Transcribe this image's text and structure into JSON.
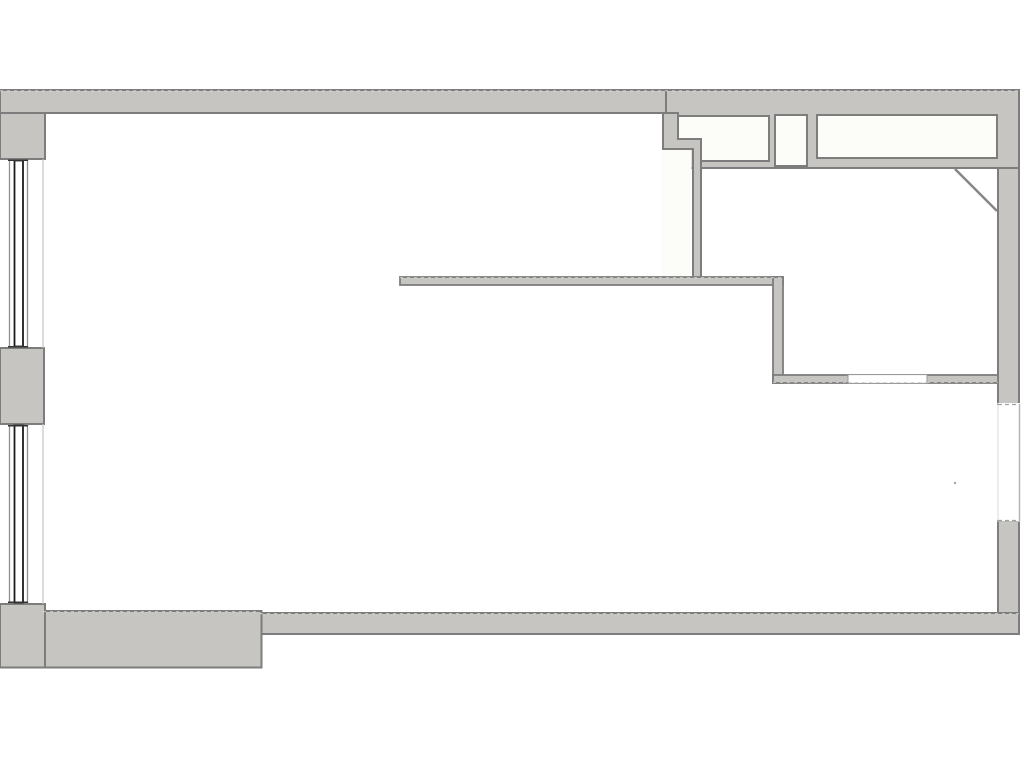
{
  "meta": {
    "title": "Floor plan drawing",
    "canvas_width": 1024,
    "canvas_height": 768
  },
  "colors": {
    "background": "#ffffff",
    "paper": "#fcfcf8",
    "wall_fill": "#c6c5c2",
    "wall_line": "#7d7d7d",
    "diag_line": "#868686",
    "window_dark": "#1c1c1c",
    "window_cap": "#333333",
    "window_mid": "#8f8f8f",
    "window_light": "#c6c6c6",
    "thin_line": "#9a9a9a",
    "dash_line": "#a0a0a0",
    "gap_outer": "#b5b5b5",
    "gap_inner": "#d9d9d9",
    "white": "#ffffff",
    "speck": "#a5a5a5",
    "dash_overlay": "#ffffff"
  },
  "shapes": [
    {
      "name": "left-wall-upper-block",
      "type": "rect",
      "x": 0,
      "y": 90,
      "w": 45,
      "h": 69,
      "fill": "wall_fill",
      "stroke": "wall_line",
      "sw": 2
    },
    {
      "name": "left-wall-pier",
      "type": "rect",
      "x": 0,
      "y": 348,
      "w": 44,
      "h": 76,
      "fill": "wall_fill",
      "stroke": "wall_line",
      "sw": 2
    },
    {
      "name": "right-wall-upper",
      "type": "rect",
      "x": 998,
      "y": 90,
      "w": 21,
      "h": 314,
      "fill": "wall_fill",
      "stroke": "wall_line",
      "sw": 2
    },
    {
      "name": "right-wall-lower",
      "type": "rect",
      "x": 998,
      "y": 521,
      "w": 21,
      "h": 113,
      "fill": "wall_fill",
      "stroke": "wall_line",
      "sw": 2
    },
    {
      "name": "top-right-wall-block",
      "type": "rect",
      "x": 663,
      "y": 90,
      "w": 356,
      "h": 78,
      "fill": "wall_fill",
      "stroke": "wall_line",
      "sw": 2
    },
    {
      "name": "top-wall",
      "type": "rect",
      "x": 0,
      "y": 90,
      "w": 666,
      "h": 23,
      "fill": "wall_fill",
      "stroke": "wall_line",
      "sw": 2
    },
    {
      "name": "open-area-notch",
      "type": "rect",
      "x": 661.5,
      "y": 150,
      "w": 30,
      "h": 128,
      "fill": "paper"
    },
    {
      "name": "interior-wall-step",
      "type": "path",
      "d": "M663,113 L678,113 L678,139 L701,139 L701,278 L693,278 L693,149 L663,149 Z",
      "fill": "wall_fill",
      "stroke": "wall_line",
      "sw": 2
    },
    {
      "name": "room-closet",
      "type": "path",
      "d": "M678,116 L769,116 L769,161 L701,161 L701,139 L678,139 Z",
      "fill": "paper",
      "stroke": "wall_line",
      "sw": 2
    },
    {
      "name": "room-shaft",
      "type": "rect",
      "x": 775,
      "y": 115,
      "w": 32,
      "h": 51,
      "fill": "paper",
      "stroke": "wall_line",
      "sw": 2
    },
    {
      "name": "room-top-right",
      "type": "rect",
      "x": 817,
      "y": 115,
      "w": 180,
      "h": 43,
      "fill": "paper",
      "stroke": "wall_line",
      "sw": 2
    },
    {
      "name": "door-diagonal-line",
      "type": "line",
      "x1": 955,
      "y1": 169,
      "x2": 997,
      "y2": 211,
      "stroke": "diag_line",
      "sw": 2.5
    },
    {
      "name": "interior-wall-long",
      "type": "rect",
      "x": 400,
      "y": 277,
      "w": 383,
      "h": 8,
      "fill": "wall_fill",
      "stroke": "wall_line",
      "sw": 1.8
    },
    {
      "name": "interior-wall-vertical",
      "type": "rect",
      "x": 773,
      "y": 277,
      "w": 10,
      "h": 106,
      "fill": "wall_fill",
      "stroke": "wall_line",
      "sw": 1.8
    },
    {
      "name": "interior-wall-lower",
      "type": "rect",
      "x": 773,
      "y": 375,
      "w": 225,
      "h": 8,
      "fill": "wall_fill",
      "stroke": "wall_line",
      "sw": 1.8
    },
    {
      "name": "interior-wall-opening",
      "type": "rect",
      "x": 848,
      "y": 374.6,
      "w": 79,
      "h": 8.8,
      "fill": "white",
      "stroke": "thin_line",
      "sw": 1
    },
    {
      "name": "opening-dash-edge",
      "type": "line",
      "x1": 848,
      "y1": 383,
      "x2": 927,
      "y2": 383,
      "stroke": "dash_line",
      "sw": 1,
      "dash": "4,3"
    },
    {
      "name": "bottom-wall-main",
      "type": "rect",
      "x": 260,
      "y": 613,
      "w": 759,
      "h": 21,
      "fill": "wall_fill",
      "stroke": "wall_line",
      "sw": 2
    },
    {
      "name": "bottom-wall-left",
      "type": "rect",
      "x": 43,
      "y": 611,
      "w": 218.5,
      "h": 56.5,
      "fill": "wall_fill",
      "stroke": "wall_line",
      "sw": 2
    },
    {
      "name": "bottom-wall-left-corner",
      "type": "rect",
      "x": 0,
      "y": 604,
      "w": 45,
      "h": 63.5,
      "fill": "wall_fill",
      "stroke": "wall_line",
      "sw": 2
    },
    {
      "name": "right-window-gap",
      "type": "rect",
      "x": 997.5,
      "y": 403,
      "w": 23.5,
      "h": 118.5,
      "fill": "white"
    },
    {
      "name": "right-window-outer-line",
      "type": "line",
      "x1": 1019.5,
      "y1": 404,
      "x2": 1019.5,
      "y2": 521,
      "stroke": "gap_outer",
      "sw": 1.5
    },
    {
      "name": "right-window-inner-line",
      "type": "line",
      "x1": 998,
      "y1": 404,
      "x2": 998,
      "y2": 521,
      "stroke": "gap_inner",
      "sw": 1
    },
    {
      "name": "right-window-dash-top",
      "type": "line",
      "x1": 998,
      "y1": 404.5,
      "x2": 1019,
      "y2": 404.5,
      "stroke": "dash_line",
      "sw": 1.3,
      "dash": "4,3"
    },
    {
      "name": "right-window-dash-bottom",
      "type": "line",
      "x1": 998,
      "y1": 520.5,
      "x2": 1019,
      "y2": 520.5,
      "stroke": "dash_line",
      "sw": 1.3,
      "dash": "4,3"
    },
    {
      "name": "window1-side-line-left",
      "type": "line",
      "x1": 9.5,
      "y1": 159.5,
      "x2": 9.5,
      "y2": 347,
      "stroke": "window_mid",
      "sw": 1.3
    },
    {
      "name": "window1-frame",
      "type": "rect",
      "x": 14.5,
      "y": 160.5,
      "w": 8.5,
      "h": 186,
      "fill": "none",
      "stroke": "window_dark",
      "sw": 1.8
    },
    {
      "name": "window1-side-line-right",
      "type": "line",
      "x1": 27.5,
      "y1": 159.5,
      "x2": 27.5,
      "y2": 347,
      "stroke": "window_mid",
      "sw": 1.3
    },
    {
      "name": "window1-face-line",
      "type": "line",
      "x1": 43,
      "y1": 159,
      "x2": 43,
      "y2": 348,
      "stroke": "window_light",
      "sw": 1.2
    },
    {
      "name": "window1-cap-top",
      "type": "line",
      "x1": 8,
      "y1": 160.3,
      "x2": 28,
      "y2": 160.3,
      "stroke": "window_cap",
      "sw": 1.5
    },
    {
      "name": "window1-cap-bottom",
      "type": "line",
      "x1": 8,
      "y1": 346.7,
      "x2": 28,
      "y2": 346.7,
      "stroke": "window_cap",
      "sw": 1.5
    },
    {
      "name": "window2-side-line-left",
      "type": "line",
      "x1": 9.5,
      "y1": 424.5,
      "x2": 9.5,
      "y2": 603,
      "stroke": "window_mid",
      "sw": 1.3
    },
    {
      "name": "window2-frame",
      "type": "rect",
      "x": 14.5,
      "y": 425.5,
      "w": 8.5,
      "h": 177,
      "fill": "none",
      "stroke": "window_dark",
      "sw": 1.8
    },
    {
      "name": "window2-side-line-right",
      "type": "line",
      "x1": 27.5,
      "y1": 424.5,
      "x2": 27.5,
      "y2": 603,
      "stroke": "window_mid",
      "sw": 1.3
    },
    {
      "name": "window2-face-line",
      "type": "line",
      "x1": 43,
      "y1": 424,
      "x2": 43,
      "y2": 604,
      "stroke": "window_light",
      "sw": 1.2
    },
    {
      "name": "window2-cap-top",
      "type": "line",
      "x1": 8,
      "y1": 425.8,
      "x2": 28,
      "y2": 425.8,
      "stroke": "window_cap",
      "sw": 1.5
    },
    {
      "name": "window2-cap-bottom",
      "type": "line",
      "x1": 8,
      "y1": 602.3,
      "x2": 28,
      "y2": 602.3,
      "stroke": "window_cap",
      "sw": 1.5
    },
    {
      "name": "top-wall-dash-texture",
      "type": "line",
      "x1": 0,
      "y1": 90.8,
      "x2": 1019,
      "y2": 90.8,
      "stroke": "dash_overlay",
      "sw": 0.8,
      "dash": "3,4",
      "opacity": 0.65
    },
    {
      "name": "long-wall-dash-texture",
      "type": "line",
      "x1": 400,
      "y1": 277.7,
      "x2": 783,
      "y2": 277.7,
      "stroke": "dash_overlay",
      "sw": 0.8,
      "dash": "3,4",
      "opacity": 0.65
    },
    {
      "name": "bottom-wall-dash-texture",
      "type": "line",
      "x1": 260,
      "y1": 613.7,
      "x2": 1019,
      "y2": 613.7,
      "stroke": "dash_overlay",
      "sw": 0.8,
      "dash": "3,4",
      "opacity": 0.65
    },
    {
      "name": "bottom-left-wall-dash-texture",
      "type": "line",
      "x1": 43,
      "y1": 611.7,
      "x2": 260,
      "y2": 611.7,
      "stroke": "dash_overlay",
      "sw": 0.8,
      "dash": "3,4",
      "opacity": 0.65
    },
    {
      "name": "lower-wall-dash-texture",
      "type": "line",
      "x1": 773,
      "y1": 382.4,
      "x2": 998,
      "y2": 382.4,
      "stroke": "dash_overlay",
      "sw": 0.8,
      "dash": "3,4",
      "opacity": 0.65
    },
    {
      "name": "plan-speck",
      "type": "circle",
      "cx": 955,
      "cy": 483,
      "r": 1.2,
      "fill": "speck"
    }
  ]
}
